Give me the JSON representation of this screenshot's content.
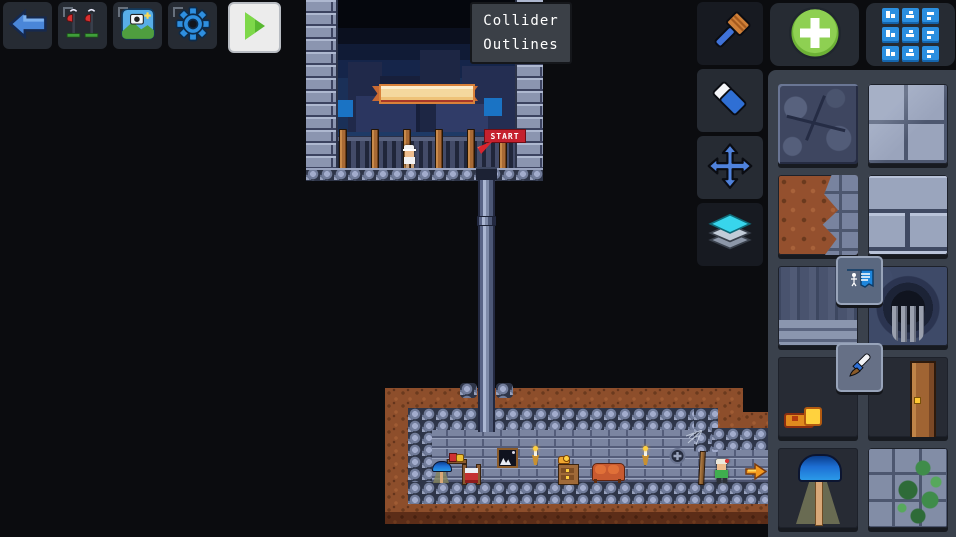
{
  "tooltip": {
    "line1": "Collider",
    "line2": "Outlines"
  },
  "topbar": {
    "back_label": "Back",
    "levels_label": "Levels",
    "scene_label": "Scene background",
    "settings_label": "Settings",
    "play_label": "Play level"
  },
  "tools": {
    "brush_label": "Paint brush",
    "eraser_label": "Eraser",
    "move_label": "Move",
    "layers_label": "Layers"
  },
  "palette": {
    "add_label": "Add tile",
    "categories_label": "Tile categories",
    "badge_sign_label": "Sign decal",
    "badge_brush_label": "Paint decal",
    "tiles": [
      {
        "name": "cracked-stone"
      },
      {
        "name": "stone-blocks"
      },
      {
        "name": "dirt-stone-edge"
      },
      {
        "name": "stone-bricks"
      },
      {
        "name": "weathered-wall"
      },
      {
        "name": "cave-hole"
      },
      {
        "name": "torch"
      },
      {
        "name": "door"
      },
      {
        "name": "lamp"
      },
      {
        "name": "vine-wall"
      }
    ]
  },
  "canvas": {
    "start_label": "START",
    "objects": {
      "banner": "banner",
      "player": "player-character",
      "npc": "npc-character",
      "exit": "exit-arrow",
      "lamp": "lamp",
      "bed": "bed",
      "couch": "couch",
      "dresser": "dresser",
      "picture": "picture-frame",
      "shield": "shield-crest"
    }
  },
  "colors": {
    "accent_blue": "#2e8fe0",
    "accent_green": "#8cd34a",
    "panel": "#262b33",
    "palette_bg": "#3a414c",
    "start_red": "#c5212e",
    "canvas_bg": "#0b0c0f"
  }
}
